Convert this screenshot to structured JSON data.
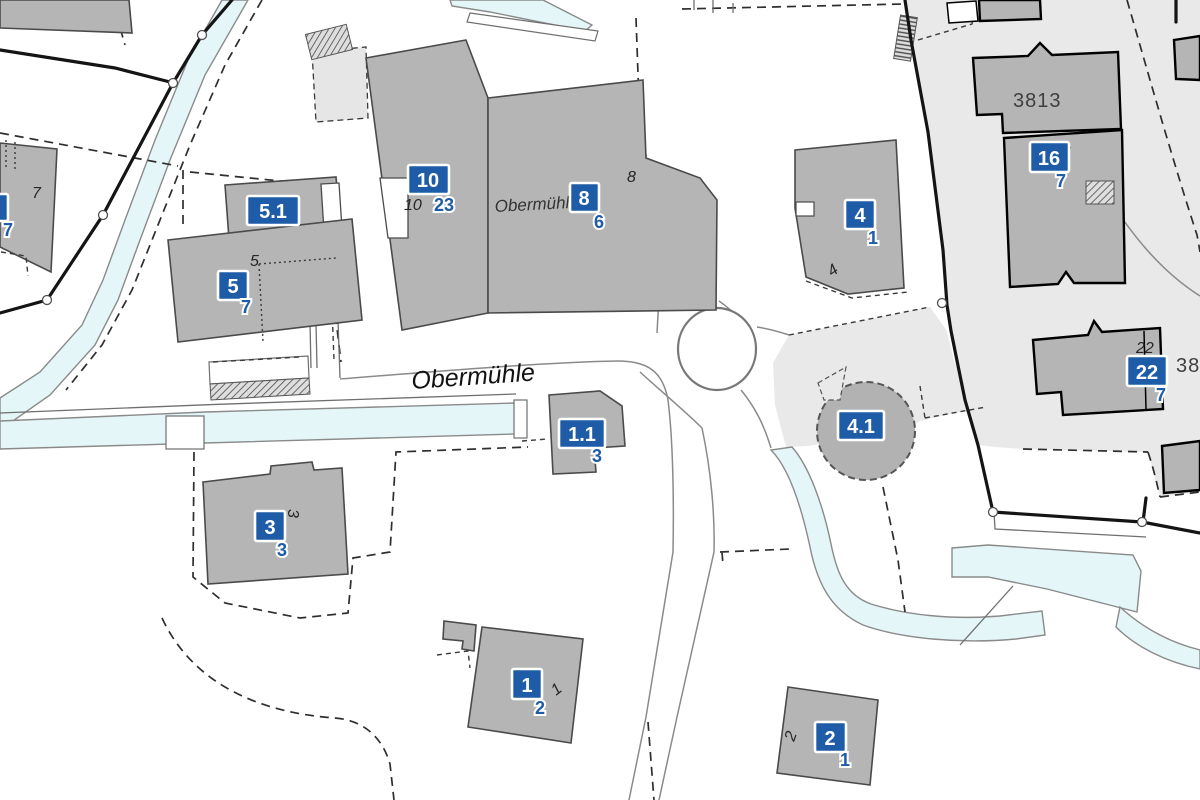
{
  "street": {
    "name": "Obermühle"
  },
  "building_name": {
    "text": "Obermühle"
  },
  "boxes": {
    "b51": {
      "label": "5.1"
    },
    "b5": {
      "label": "5",
      "sub": "7"
    },
    "b10": {
      "label": "10",
      "sub": "23"
    },
    "b8": {
      "label": "8",
      "sub": "6"
    },
    "b4": {
      "label": "4",
      "sub": "1"
    },
    "b41": {
      "label": "4.1"
    },
    "b11": {
      "label": "1.1",
      "sub": "3"
    },
    "b3": {
      "label": "3",
      "sub": "3"
    },
    "b1": {
      "label": "1",
      "sub": "2"
    },
    "b2": {
      "label": "2",
      "sub": "1"
    },
    "b16": {
      "label": "16",
      "sub": "7"
    },
    "b22": {
      "label": "22",
      "sub": "7"
    },
    "b7cut": {
      "sub": "7"
    }
  },
  "house_numbers": {
    "h7": "7",
    "h5": "5",
    "h10": "10",
    "h8": "8",
    "h4": "4",
    "h3": "3",
    "h1": "1",
    "h2": "2",
    "h22": "22",
    "h5b": "5"
  },
  "parcel_numbers": {
    "p3813": "3813",
    "p381": "381"
  },
  "colors": {
    "label_box_blue": "#1e5ca8",
    "building_gray": "#b5b5b5",
    "zone_gray": "#e9e9e9",
    "water_blue": "#e4f6f8",
    "boundary_black": "#141414"
  }
}
